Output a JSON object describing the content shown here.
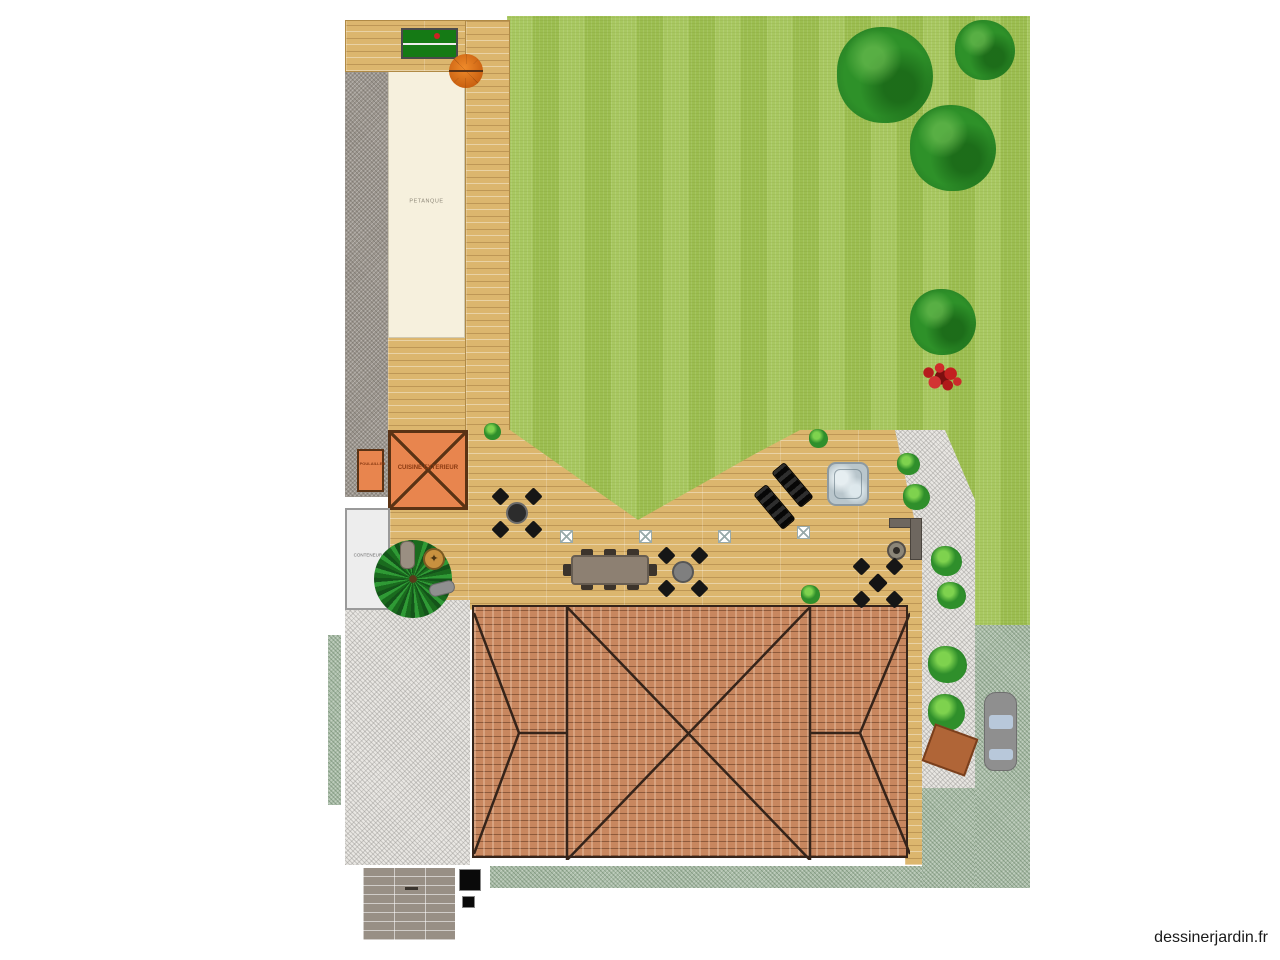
{
  "watermark": {
    "text": "dessinerjardin.fr"
  },
  "plan_labels": {
    "petanque": "PETANQUE",
    "outdoor_kitchen": "CUISINE EXTERIEUR",
    "coop": "POULAILLER",
    "container": "CONTENEUR"
  },
  "colors": {
    "lawn_green": "#a2c455",
    "tree_green": "#2e9129",
    "deck_wood": "#dcb66e",
    "roof_tiles": "#c8875f",
    "kitchen_orange": "#e8854e",
    "petanque_sand": "#f6f0dd",
    "gravel_white": "#e9e7e3",
    "gravel_gray": "#9b958d",
    "driveway_green": "#a9bca7",
    "jacuzzi_blue": "#b9c6cc",
    "flower_red": "#c32020"
  },
  "objects": [
    {
      "name": "lawn",
      "type": "grass-area"
    },
    {
      "name": "petanque-court",
      "label_key": "petanque"
    },
    {
      "name": "table-tennis-table"
    },
    {
      "name": "parasol"
    },
    {
      "name": "outdoor-kitchen",
      "label_key": "outdoor_kitchen"
    },
    {
      "name": "chicken-coop",
      "label_key": "coop"
    },
    {
      "name": "container-box",
      "label_key": "container"
    },
    {
      "name": "tree",
      "count": 4
    },
    {
      "name": "shrub",
      "count": 9
    },
    {
      "name": "red-flower-bed"
    },
    {
      "name": "palm-tree"
    },
    {
      "name": "jacuzzi"
    },
    {
      "name": "sun-lounger",
      "count": 2
    },
    {
      "name": "dining-table-8-seats"
    },
    {
      "name": "bistro-set",
      "count": 3
    },
    {
      "name": "fire-pit",
      "count": 2
    },
    {
      "name": "outdoor-counter-L"
    },
    {
      "name": "deck-spotlight",
      "count": 4
    },
    {
      "name": "barrel"
    },
    {
      "name": "bench"
    },
    {
      "name": "planter-tilted"
    },
    {
      "name": "car"
    },
    {
      "name": "house-roof"
    },
    {
      "name": "wood-deck"
    },
    {
      "name": "white-gravel-path"
    },
    {
      "name": "gray-gravel-path"
    },
    {
      "name": "driveway"
    },
    {
      "name": "paving-square"
    },
    {
      "name": "black-storage-box",
      "count": 2
    }
  ]
}
